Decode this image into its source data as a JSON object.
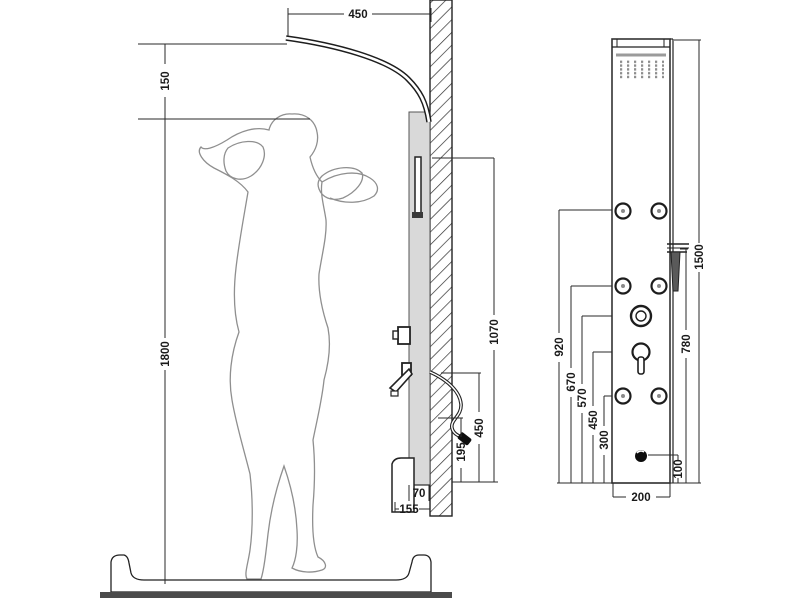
{
  "drawing": {
    "subject": "Shower panel installation dimension drawing",
    "side_view": {
      "dim_top_offset": "450",
      "dim_head_clearance": "150",
      "dim_person_height": "1800",
      "dim_holder_height": "1070",
      "dim_hose_outlet_height": "450",
      "dim_hose_end_height": "195",
      "dim_panel_depth": "70",
      "dim_base_depth": "155"
    },
    "front_view": {
      "dim_total_height": "1500",
      "dim_hand_shower_height": "780",
      "dim_jets_top": "920",
      "dim_jets_middle": "670",
      "dim_diverter_height": "570",
      "dim_mixer_height": "450",
      "dim_jets_bottom": "300",
      "dim_spout_offset": "100",
      "dim_panel_width": "200"
    },
    "colors": {
      "line": "#2a2a2a",
      "panel_fill": "#d9d9d9",
      "floor": "#4b4b4b",
      "figure": "#8f8f8f"
    }
  }
}
